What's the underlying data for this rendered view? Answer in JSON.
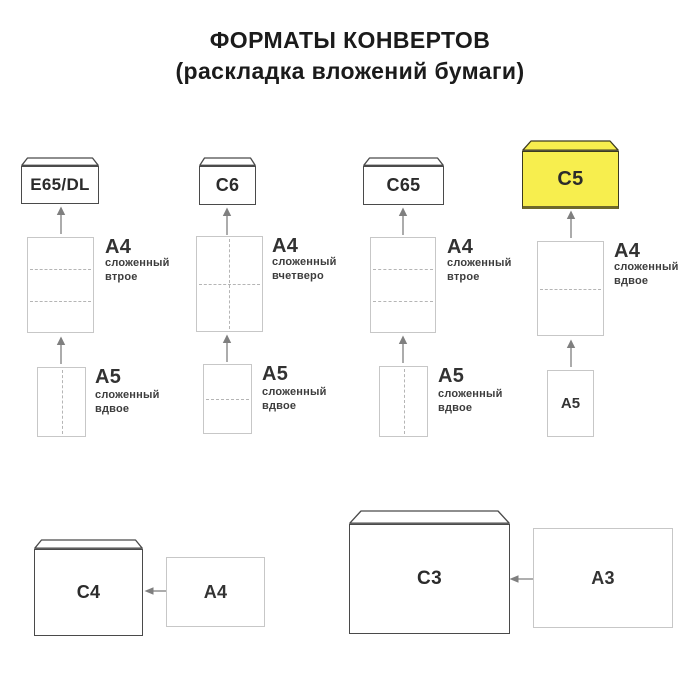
{
  "title": {
    "line1": "ФОРМАТЫ КОНВЕРТОВ",
    "line2": "(раскладка вложений бумаги)"
  },
  "columns": [
    {
      "envelope_label": "E65/DL",
      "a4": {
        "label": "A4",
        "fold": "сложенный\nвтрое"
      },
      "a5": {
        "label": "A5",
        "fold": "сложенный\nвдвое"
      }
    },
    {
      "envelope_label": "C6",
      "a4": {
        "label": "A4",
        "fold": "сложенный\nвчетверо"
      },
      "a5": {
        "label": "A5",
        "fold": "сложенный\nвдвое"
      }
    },
    {
      "envelope_label": "C65",
      "a4": {
        "label": "A4",
        "fold": "сложенный\nвтрое"
      },
      "a5": {
        "label": "A5",
        "fold": "сложенный\nвдвое"
      }
    },
    {
      "envelope_label": "C5",
      "highlighted": true,
      "a4": {
        "label": "A4",
        "fold": "сложенный\nвдвое"
      },
      "a5": {
        "label": "A5"
      }
    }
  ],
  "bottom_pairs": [
    {
      "envelope_label": "C4",
      "paper_label": "A4"
    },
    {
      "envelope_label": "C3",
      "paper_label": "A3"
    }
  ],
  "colors": {
    "highlight_yellow": "#f7ee4e",
    "envelope_border": "#4a4a4a",
    "paper_border": "#c7c7c7",
    "fold_line": "#b5b5b5",
    "arrow": "#7f7f7f",
    "title_text": "#1b1b1b",
    "label_text": "#323232"
  }
}
